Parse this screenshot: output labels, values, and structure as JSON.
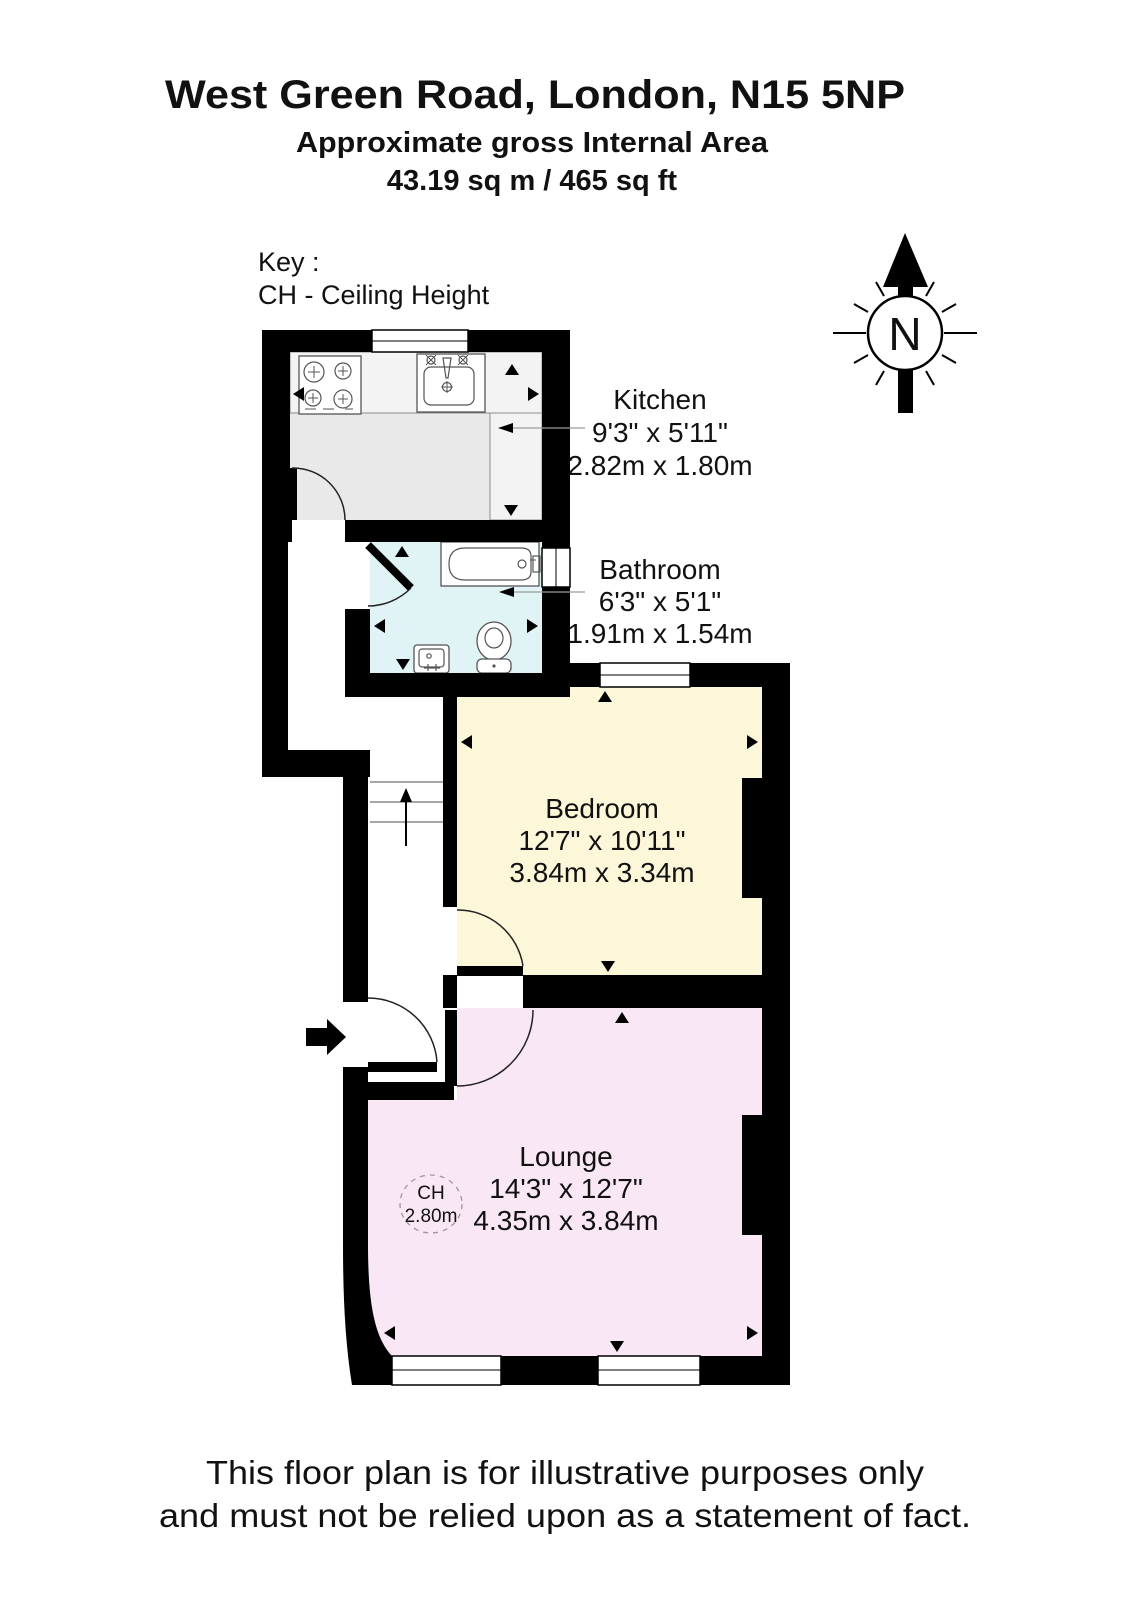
{
  "header": {
    "title": "West Green Road, London, N15 5NP",
    "subtitle1": "Approximate gross Internal Area",
    "subtitle2": "43.19 sq m / 465 sq ft"
  },
  "key": {
    "line1": "Key :",
    "line2": "CH - Ceiling Height"
  },
  "compass": {
    "label": "N"
  },
  "rooms": {
    "kitchen": {
      "name": "Kitchen",
      "imperial": "9'3\" x 5'11\"",
      "metric": "2.82m x 1.80m",
      "floor_color": "#e9e9e9"
    },
    "bathroom": {
      "name": "Bathroom",
      "imperial": "6'3\" x 5'1\"",
      "metric": "1.91m x 1.54m",
      "floor_color": "#e0f4f6"
    },
    "bedroom": {
      "name": "Bedroom",
      "imperial": "12'7\" x 10'11\"",
      "metric": "3.84m x 3.34m",
      "floor_color": "#fbf7d8"
    },
    "lounge": {
      "name": "Lounge",
      "imperial": "14'3\" x 12'7\"",
      "metric": "4.35m x 3.84m",
      "floor_color": "#f9e7f5",
      "ch_label": "CH",
      "ch_value": "2.80m"
    }
  },
  "colors": {
    "wall": "#000000"
  },
  "footer": {
    "line1": "This floor plan is for illustrative purposes only",
    "line2": "and must not be relied upon as a statement of fact."
  }
}
